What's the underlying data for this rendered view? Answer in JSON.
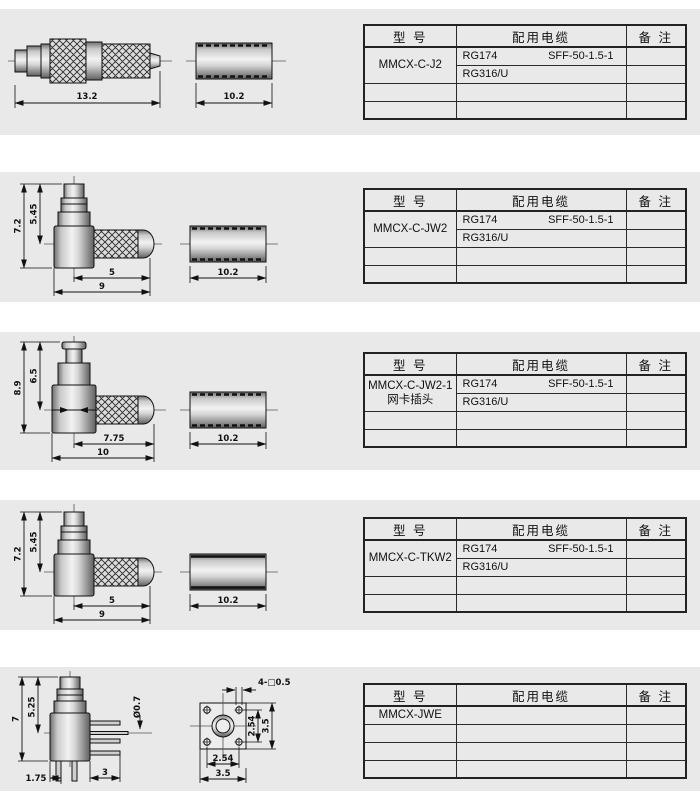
{
  "page": {
    "colors": {
      "band_bg": "#e9e9e9",
      "line": "#111111",
      "table_border": "#222222"
    }
  },
  "table_header": {
    "model": "型  号",
    "cable": "配用电缆",
    "note": "备  注"
  },
  "sections": [
    {
      "model": "MMCX-C-J2",
      "model2": "",
      "cable1a": "RG174",
      "cable1b": "SFF-50-1.5-1",
      "cable2": "RG316/U",
      "dims": {
        "body": "13.2",
        "sleeve": "10.2"
      }
    },
    {
      "model": "MMCX-C-JW2",
      "model2": "",
      "cable1a": "RG174",
      "cable1b": "SFF-50-1.5-1",
      "cable2": "RG316/U",
      "dims": {
        "height": "7.2",
        "inner": "5.45",
        "knurl": "5",
        "body": "9",
        "sleeve": "10.2"
      }
    },
    {
      "model": "MMCX-C-JW2-1",
      "model2": "网卡插头",
      "cable1a": "RG174",
      "cable1b": "SFF-50-1.5-1",
      "cable2": "RG316/U",
      "dims": {
        "height": "8.9",
        "inner": "6.5",
        "knurl": "7.75",
        "body": "10",
        "sleeve": "10.2"
      }
    },
    {
      "model": "MMCX-C-TKW2",
      "model2": "",
      "cable1a": "RG174",
      "cable1b": "SFF-50-1.5-1",
      "cable2": "RG316/U",
      "dims": {
        "height": "7.2",
        "inner": "5.45",
        "knurl": "5",
        "body": "9",
        "sleeve": "10.2"
      }
    },
    {
      "model": "MMCX-JWE",
      "model2": "",
      "cable1a": "",
      "cable1b": "",
      "cable2": "",
      "dims": {
        "height": "7",
        "inner": "5.25",
        "pin_dia": "Ø0.7",
        "leg_offset": "1.75",
        "leg_len": "3",
        "holes": "4-□0.5",
        "pitch_v": "2.54",
        "flange_h": "3.5",
        "pitch_b": "2.54",
        "flange_w": "3.5"
      }
    }
  ]
}
